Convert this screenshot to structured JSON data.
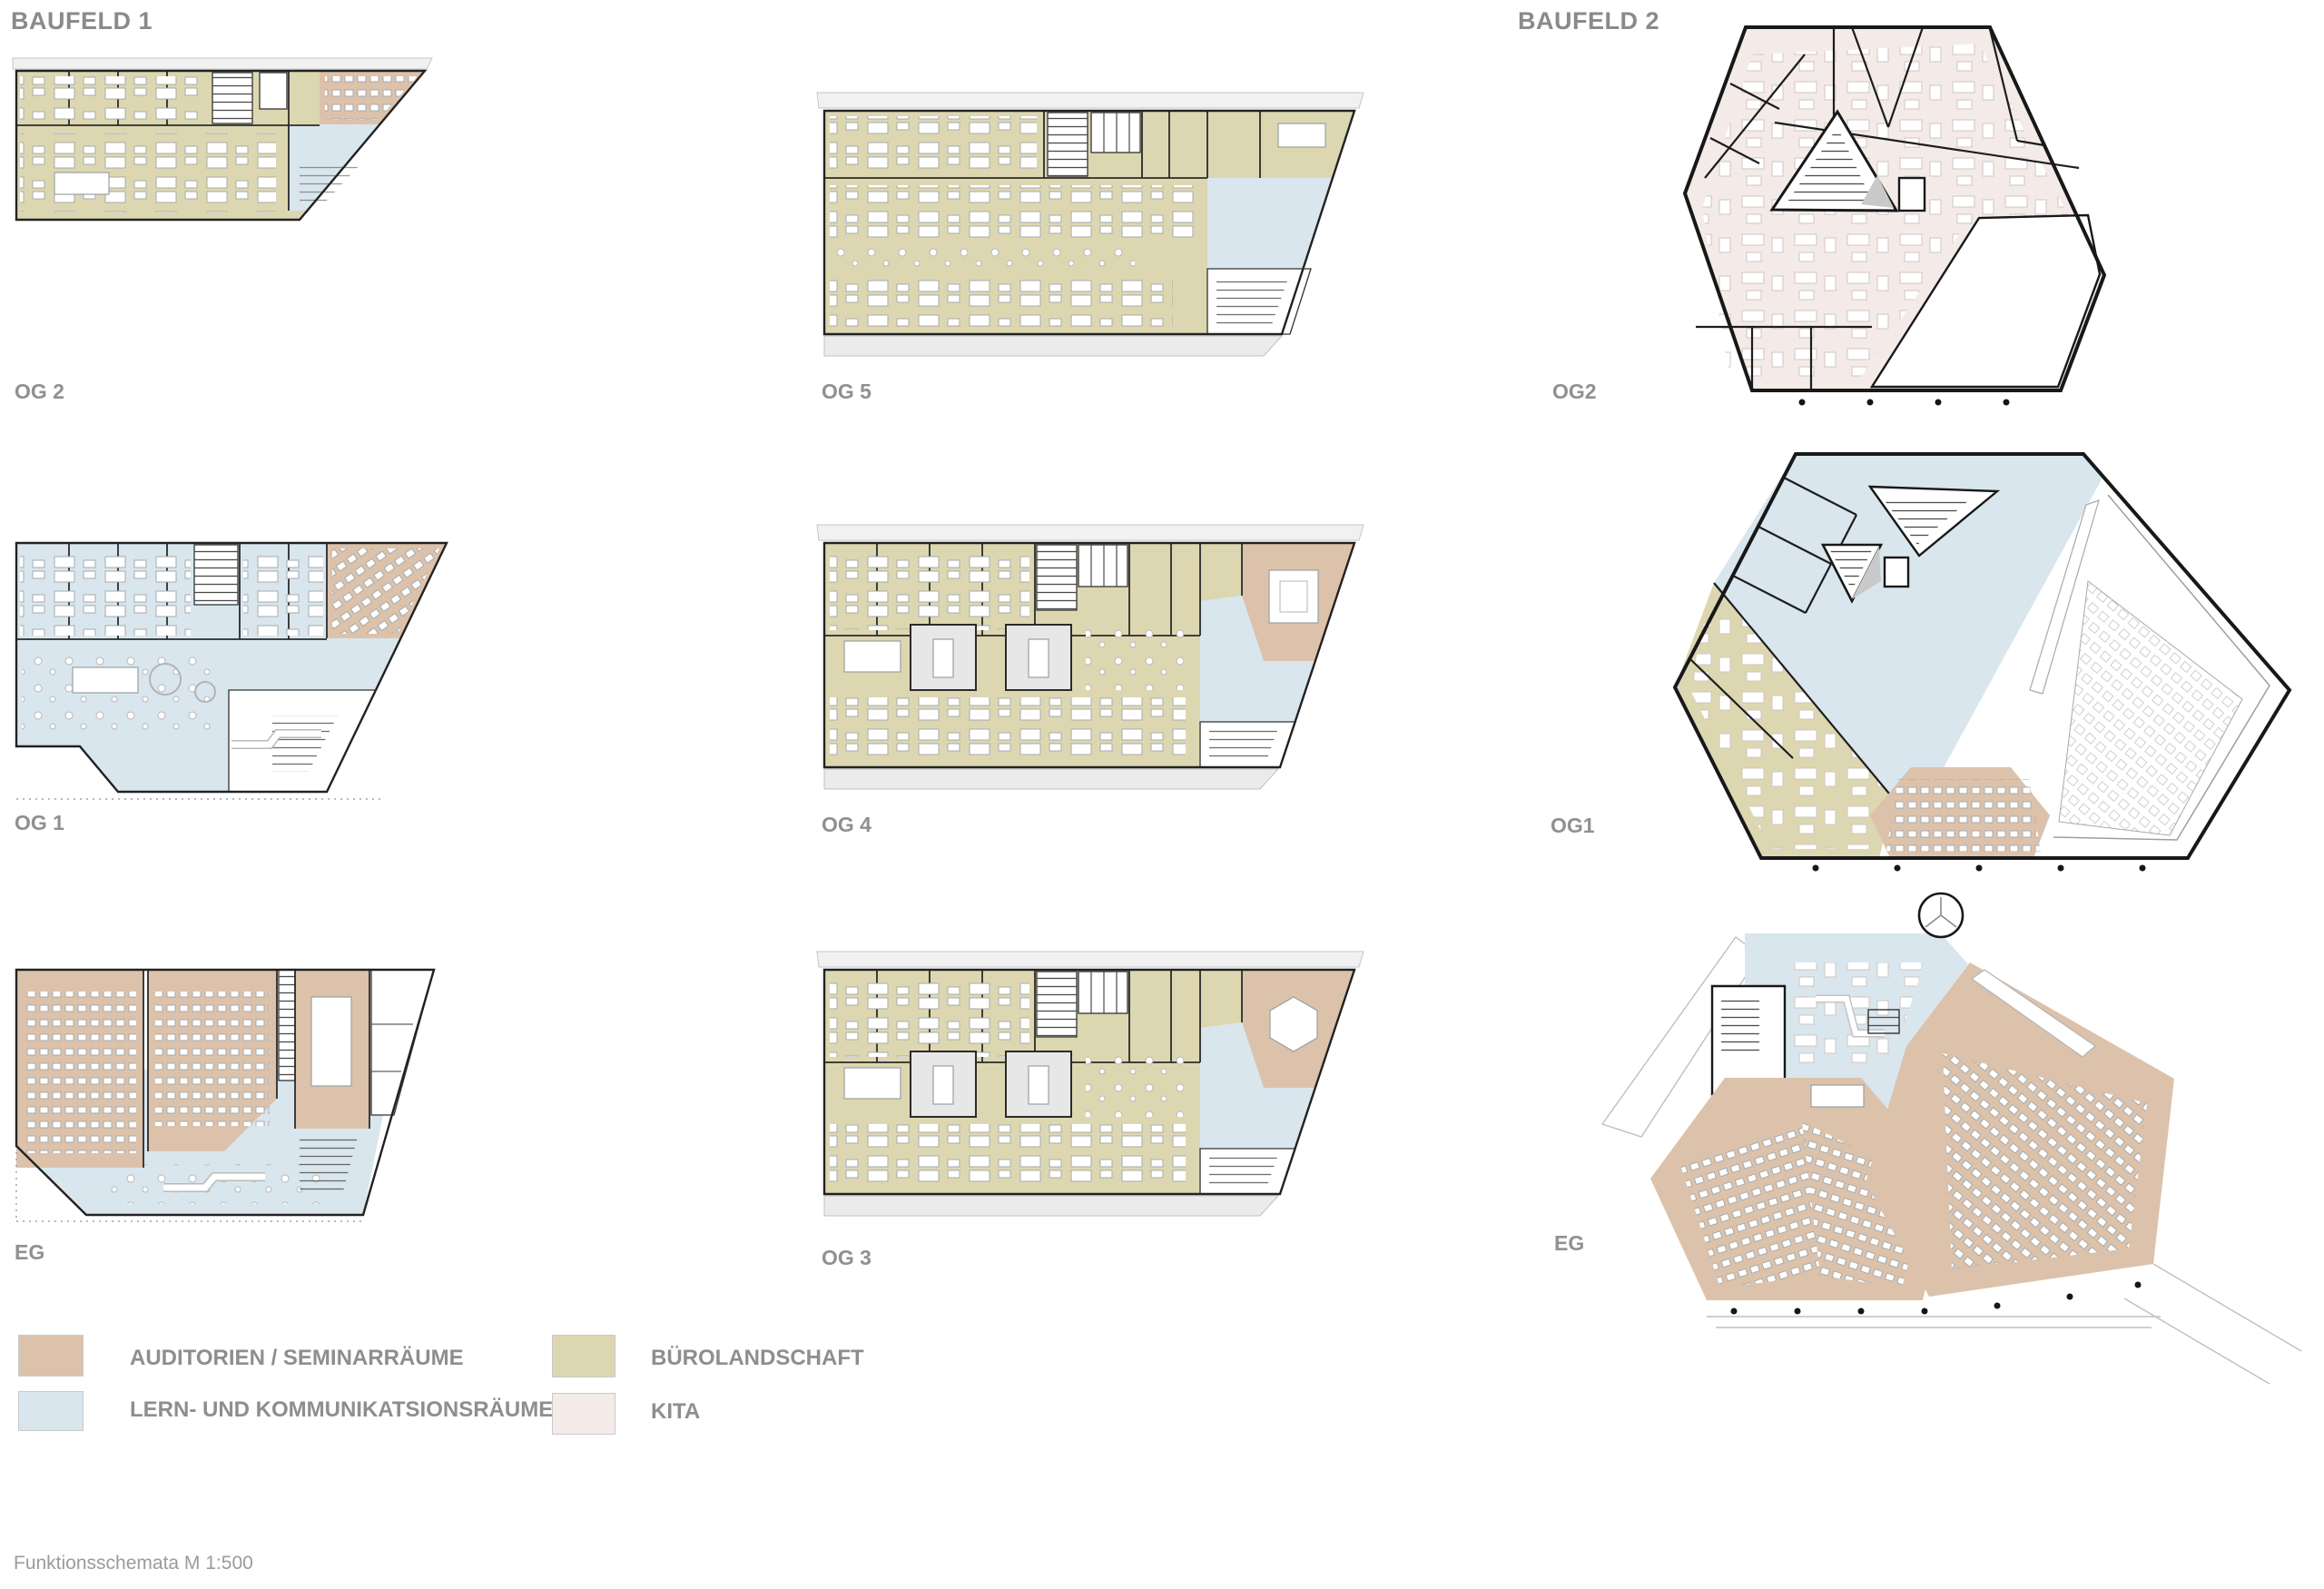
{
  "document": {
    "title_left": "BAUFELD 1",
    "title_right": "BAUFELD 2",
    "caption": "Funktionsschemata M 1:500"
  },
  "colors": {
    "auditorium": "#dcc2ab",
    "learning": "#d9e6ee",
    "office": "#ddd7b1",
    "kita": "#f4ebe9",
    "wall": "#1c1c1c",
    "label": "#8f9091",
    "furniture": "#a6abad",
    "slab": "#ededed"
  },
  "plans": {
    "b1_og2": {
      "label": "OG 2"
    },
    "b1_og1": {
      "label": "OG 1"
    },
    "b1_eg": {
      "label": "EG"
    },
    "m_og5": {
      "label": "OG 5"
    },
    "m_og4": {
      "label": "OG 4"
    },
    "m_og3": {
      "label": "OG 3"
    },
    "b2_og2": {
      "label": "OG2"
    },
    "b2_og1": {
      "label": "OG1"
    },
    "b2_eg": {
      "label": "EG"
    }
  },
  "legend": {
    "items": [
      {
        "label": "AUDITORIEN / SEMINARRÄUME",
        "color_key": "auditorium"
      },
      {
        "label": "LERN- UND KOMMUNIKATSIONSRÄUME",
        "color_key": "learning"
      },
      {
        "label": "BÜROLANDSCHAFT",
        "color_key": "office"
      },
      {
        "label": "KITA",
        "color_key": "kita"
      }
    ]
  }
}
